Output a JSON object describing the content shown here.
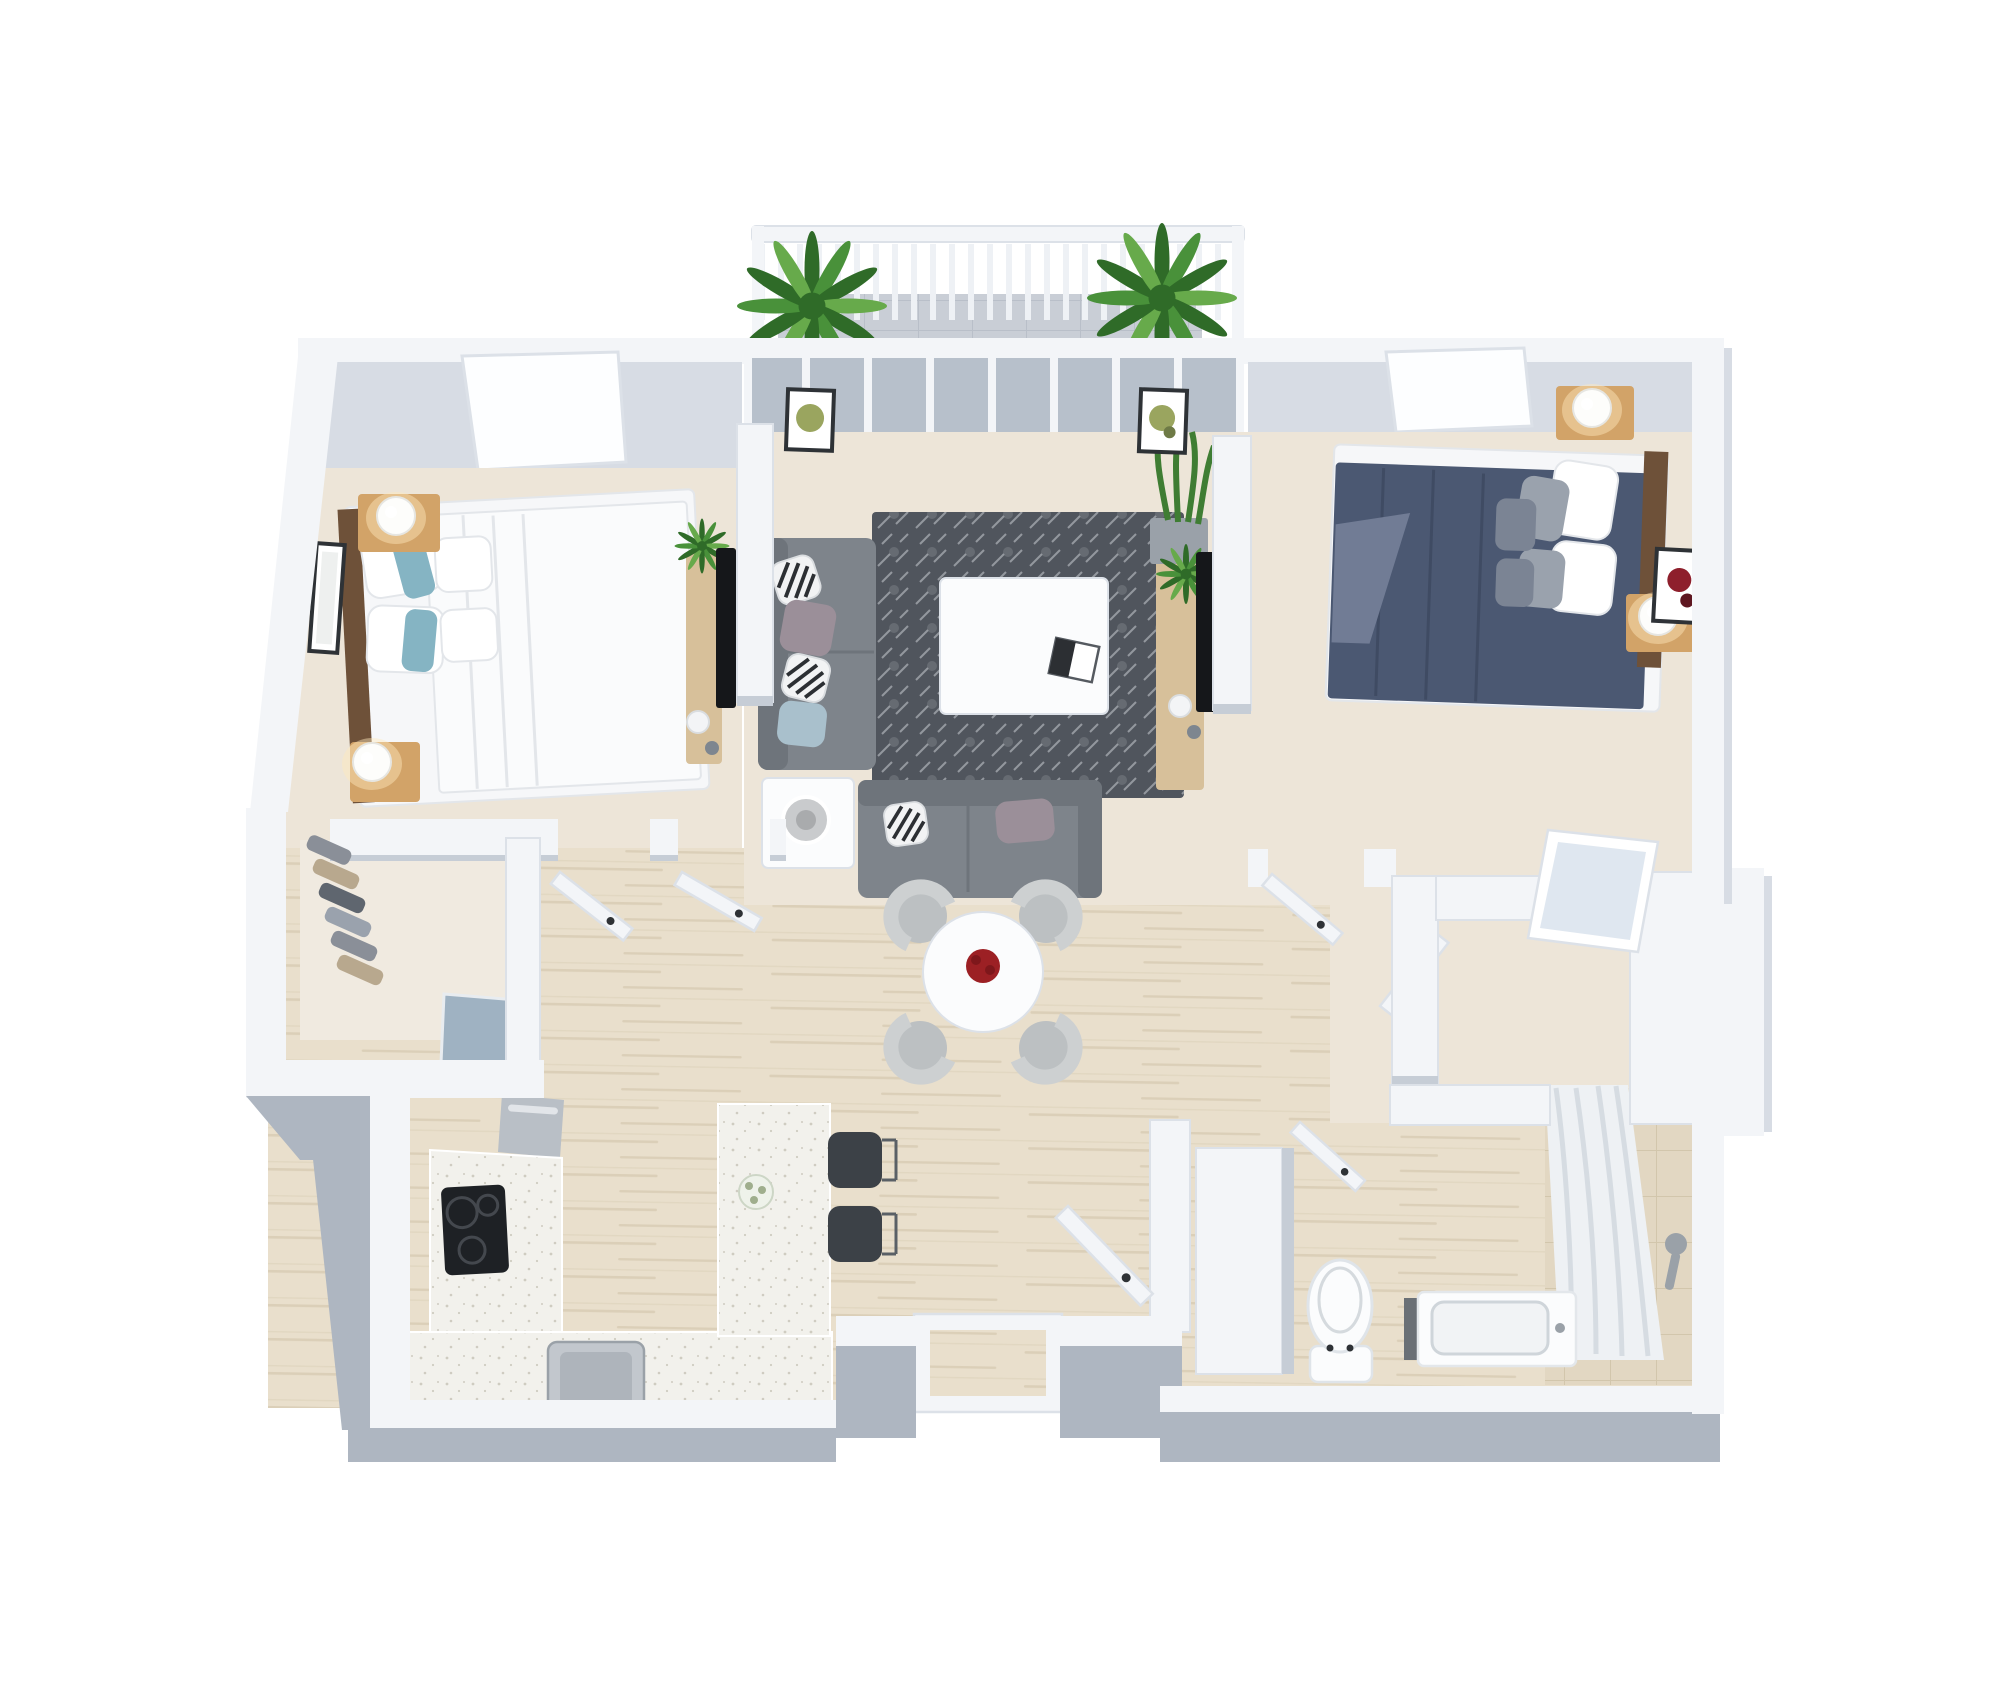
{
  "meta": {
    "title": "3D isometric floor plan rendering — two-bedroom apartment",
    "view": "top-down 3D dollhouse render",
    "background": "#ffffff"
  },
  "palette": {
    "wall_white": "#f3f5f8",
    "wall_edge": "#dce1e8",
    "wall_face": "#c6cdd6",
    "wall_face_light": "#d7dce4",
    "wall_gray": "#aeb6c1",
    "floor_beige": "#ede5d8",
    "floor_wood": "#e9dfcc",
    "wood_grain": "#dbcfb8",
    "closet_floor": "#f0eae0",
    "balcony_tile": "#c9ced6",
    "balcony_line": "#b9bfc9",
    "glass": "#b7c0cb",
    "window_white": "#fdfeff",
    "plant_dark": "#2f6b28",
    "plant_mid": "#49913a",
    "plant_light": "#67aa4b",
    "headboard_wood": "#6e5139",
    "nightstand_wood": "#d2a368",
    "bed_white": "#f6f7f9",
    "duvet_fold": "#e3e6ea",
    "teal_pillow": "#85b4c3",
    "navy_duvet": "#4b5872",
    "navy_fold": "#3f4b63",
    "gray_pillow": "#9aa2ad",
    "throw_gray": "#717c95",
    "sofa_gray": "#7e848b",
    "sofa_dark": "#6e747b",
    "rug_dark": "#50555d",
    "rug_light": "#c9cdd3",
    "mauve_pillow": "#9b8f99",
    "blue_pillow": "#a9c0cc",
    "zebra_dark": "#2c2f33",
    "table_white": "#fbfcfd",
    "chair_gray": "#cdd0d1",
    "chair_seat": "#bcc0c2",
    "rose_red": "#9c2024",
    "counter_white": "#f2f1ec",
    "counter_dot": "#cfccc1",
    "fridge_blue": "#9fb2c2",
    "stainless": "#b9bfc6",
    "cooktop_black": "#1e2125",
    "stool_dark": "#3c4147",
    "sink_steel": "#c2c7cd",
    "sink_inner": "#aeb4bb",
    "toilet_white": "#fbfcfd",
    "fixture_gray": "#9aa1a8",
    "shower_tile": "#e2d7c2",
    "shower_line": "#d2c6ac",
    "curtain": "#eef1f4",
    "curtain_fold": "#d6dce2",
    "mirror": "#dfe7f0",
    "handle": "#2e3236",
    "frame_dark": "#2e3236",
    "art_green": "#9aa55f",
    "art_red": "#8e1f2c",
    "lamp_glow": "#ffe9bd",
    "lamp_shade": "#c9cbcd",
    "decor_white": "#f3f4f6",
    "stone_gray": "#7e868f"
  },
  "scene": {
    "rooms": [
      {
        "name": "balcony",
        "furniture": [
          "railing",
          "potted-plant-left",
          "potted-plant-right",
          "tile-floor"
        ]
      },
      {
        "name": "bedroom-left",
        "furniture": [
          "double-bed-white",
          "teal-accent-pillows",
          "wood-headboard",
          "nightstand-with-lamp-top",
          "nightstand-with-lamp-bottom",
          "wall-art",
          "window"
        ]
      },
      {
        "name": "walk-in-closet-left",
        "furniture": [
          "hanging-clothes"
        ]
      },
      {
        "name": "living-room",
        "furniture": [
          "glass-sliding-doors",
          "gray-sectional-sofa",
          "patterned-rug",
          "white-coffee-table",
          "end-table-with-lamp",
          "tv-console-left",
          "tv-console-right",
          "snake-plant",
          "wall-art-left",
          "wall-art-right"
        ]
      },
      {
        "name": "bedroom-right",
        "furniture": [
          "double-bed-navy",
          "wood-headboard",
          "nightstand-with-lamp-top",
          "nightstand-with-lamp-bottom",
          "flower-wall-art",
          "window"
        ]
      },
      {
        "name": "dining-area",
        "furniture": [
          "round-white-table",
          "red-rose-centerpiece",
          "tub-chair-x4"
        ]
      },
      {
        "name": "kitchen",
        "furniture": [
          "refrigerator",
          "oven",
          "induction-cooktop",
          "quartz-counter",
          "peninsula-island",
          "flower-vase",
          "bar-stool-x2",
          "steel-sink"
        ]
      },
      {
        "name": "entry",
        "furniture": [
          "front-door-open",
          "threshold",
          "tall-cabinet"
        ]
      },
      {
        "name": "walk-in-closet-right",
        "furniture": [
          "l-shaped-wardrobe",
          "mirror-door",
          "open-doors"
        ]
      },
      {
        "name": "bathroom",
        "furniture": [
          "toilet",
          "vanity-sink",
          "shower-curtain",
          "shower-tile",
          "shower-fixture"
        ]
      }
    ],
    "doors_open_count": 6,
    "windows_count": 2
  }
}
